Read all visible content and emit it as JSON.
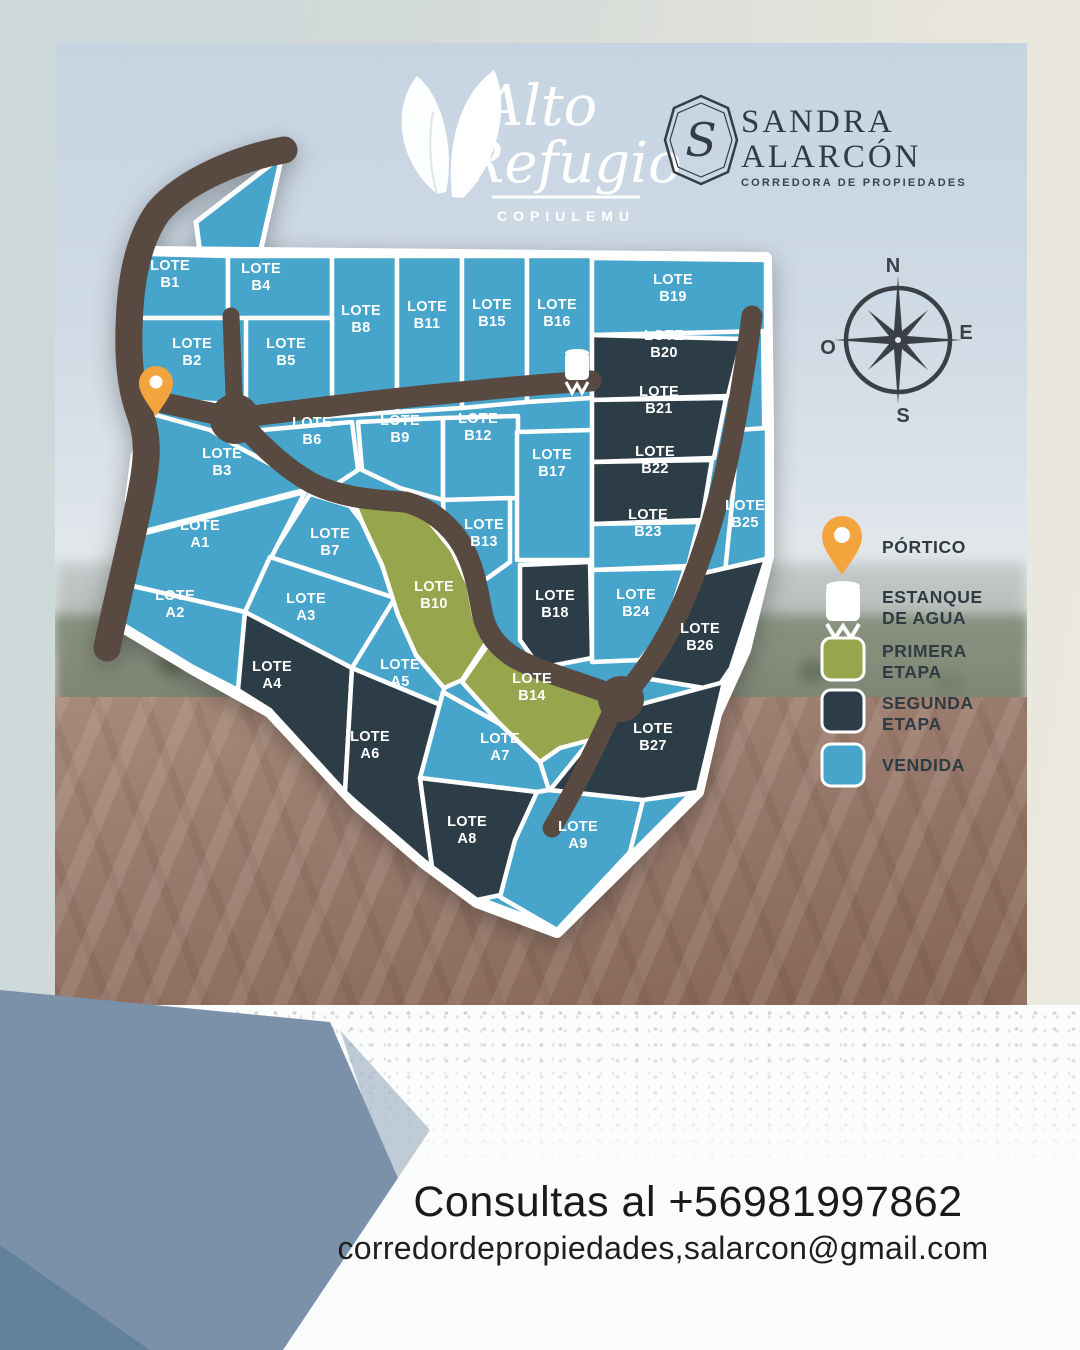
{
  "header": {
    "brand": {
      "line1": "Alto",
      "line2": "Refugio",
      "sub": "COPIULEMU"
    },
    "realtor": {
      "monogram": "S",
      "name1": "SANDRA",
      "name2": "ALARCÓN",
      "tagline": "CORREDORA DE PROPIEDADES"
    }
  },
  "compass": {
    "n": "N",
    "e": "E",
    "s": "S",
    "o": "O"
  },
  "legend": {
    "portico": "PÓRTICO",
    "estanque1": "ESTANQUE",
    "estanque2": "DE AGUA",
    "primera1": "PRIMERA",
    "primera2": "ETAPA",
    "segunda1": "SEGUNDA",
    "segunda2": "ETAPA",
    "vendida": "VENDIDA"
  },
  "colors": {
    "vendida": "#47a4cb",
    "primera": "#97a64c",
    "segunda": "#2c3d47",
    "road": "#584a40",
    "portico_pin": "#f4a43c",
    "line": "#ffffff"
  },
  "footer": {
    "line1": "Consultas al +56981997862",
    "line2": "corredordepropiedades,salarcon@gmail.com"
  },
  "map": {
    "lot_prefix": "LOTE",
    "lots": [
      {
        "id": "B1",
        "status": "vendida",
        "points": "150,254 228,256 228,318 138,318 133,292 140,268",
        "lx": 170,
        "ly": 277
      },
      {
        "id": "B4",
        "status": "vendida",
        "points": "228,256 332,256 332,318 228,318",
        "lx": 261,
        "ly": 280
      },
      {
        "id": "B8",
        "status": "vendida",
        "points": "332,256 397,256 397,412 332,416",
        "lx": 361,
        "ly": 322
      },
      {
        "id": "B11",
        "status": "vendida",
        "points": "397,256 462,256 462,408 397,412",
        "lx": 427,
        "ly": 318
      },
      {
        "id": "B15",
        "status": "vendida",
        "points": "462,256 527,256 527,402 462,408",
        "lx": 492,
        "ly": 316
      },
      {
        "id": "B16",
        "status": "vendida",
        "points": "527,256 592,256 592,398 527,402",
        "lx": 557,
        "ly": 316
      },
      {
        "id": "B19",
        "status": "vendida",
        "points": "592,258 766,260 766,331 592,335",
        "lx": 673,
        "ly": 291
      },
      {
        "id": "B2",
        "status": "vendida",
        "points": "138,318 228,318 228,404 196,402 158,398 131,364",
        "lx": 192,
        "ly": 355
      },
      {
        "id": "B5",
        "status": "vendida",
        "points": "246,318 332,318 332,412 246,408",
        "lx": 286,
        "ly": 355
      },
      {
        "id": "B6",
        "status": "vendida",
        "points": "262,430 352,422 358,470 332,487 300,477 268,452",
        "lx": 312,
        "ly": 434
      },
      {
        "id": "B9",
        "status": "vendida",
        "points": "358,422 443,418 443,500 400,488 362,470",
        "lx": 400,
        "ly": 432
      },
      {
        "id": "B12",
        "status": "vendida",
        "points": "443,418 518,416 518,498 443,500",
        "lx": 478,
        "ly": 430
      },
      {
        "id": "B13",
        "status": "vendida",
        "points": "443,500 510,498 510,562 478,585 458,552 444,520",
        "lx": 484,
        "ly": 536
      },
      {
        "id": "B17",
        "status": "vendida",
        "points": "517,432 592,430 592,560 517,560",
        "lx": 552,
        "ly": 466
      },
      {
        "id": "B3",
        "status": "vendida",
        "points": "152,414 210,430 240,448 270,464 300,480 312,488 137,533 127,500 133,455",
        "lx": 222,
        "ly": 465
      },
      {
        "id": "B7",
        "status": "vendida",
        "points": "310,494 350,506 362,522 382,565 395,598 270,557",
        "lx": 330,
        "ly": 545
      },
      {
        "id": "A1",
        "status": "vendida",
        "points": "134,536 305,492 272,556 245,612 124,584",
        "lx": 200,
        "ly": 537
      },
      {
        "id": "A2",
        "status": "vendida",
        "points": "124,584 245,612 238,690 193,667 109,616",
        "lx": 175,
        "ly": 607
      },
      {
        "id": "A3",
        "status": "vendida",
        "points": "270,557 395,598 352,668 245,612",
        "lx": 306,
        "ly": 610
      },
      {
        "id": "A4",
        "status": "segunda",
        "points": "245,612 352,668 345,792 270,710 238,690",
        "lx": 272,
        "ly": 678
      },
      {
        "id": "A5",
        "status": "vendida",
        "points": "395,598 416,655 444,688 443,706 352,668",
        "lx": 400,
        "ly": 676
      },
      {
        "id": "A6",
        "status": "segunda",
        "points": "352,668 443,706 420,778 432,867 423,860 357,803 345,792",
        "lx": 370,
        "ly": 748
      },
      {
        "id": "A7",
        "status": "vendida",
        "points": "443,692 500,724 540,762 549,790 537,792 420,778",
        "lx": 500,
        "ly": 750
      },
      {
        "id": "A8",
        "status": "segunda",
        "points": "420,778 537,792 510,893 477,900 432,867",
        "lx": 467,
        "ly": 833
      },
      {
        "id": "A9",
        "status": "vendida",
        "points": "549,790 643,800 630,852 557,930 500,897 515,840 537,792",
        "lx": 578,
        "ly": 838
      },
      {
        "id": "B10",
        "status": "primera",
        "points": "350,492 398,505 428,520 452,550 468,584 474,616 488,640 462,680 444,688 416,655 398,615 382,565 362,522",
        "lx": 434,
        "ly": 598
      },
      {
        "id": "B14",
        "status": "primera",
        "points": "462,682 490,642 516,660 556,676 598,694 610,704 598,738 560,748 540,762 500,724",
        "lx": 532,
        "ly": 690
      },
      {
        "id": "B18",
        "status": "segunda",
        "points": "520,565 590,562 592,658 540,668 520,640",
        "lx": 555,
        "ly": 607
      },
      {
        "id": "B20",
        "status": "segunda",
        "points": "592,335 742,339 728,396 592,400",
        "lx": 664,
        "ly": 347
      },
      {
        "id": "B21",
        "status": "segunda",
        "points": "592,400 726,398 714,458 592,462",
        "lx": 659,
        "ly": 403
      },
      {
        "id": "B22",
        "status": "segunda",
        "points": "592,462 712,460 702,520 592,524",
        "lx": 655,
        "ly": 463
      },
      {
        "id": "B23",
        "status": "vendida",
        "points": "592,524 699,522 688,566 592,570",
        "lx": 648,
        "ly": 526
      },
      {
        "id": "B25",
        "status": "vendida",
        "points": "737,430 767,428 767,556 746,620 725,572 733,494",
        "lx": 745,
        "ly": 517
      },
      {
        "id": "B24",
        "status": "vendida",
        "points": "592,570 685,568 666,628 640,660 592,662",
        "lx": 636,
        "ly": 606
      },
      {
        "id": "B26",
        "status": "segunda",
        "points": "668,622 695,575 766,559 731,668 716,690 644,678 648,658",
        "lx": 700,
        "ly": 640
      },
      {
        "id": "B27",
        "status": "segunda",
        "points": "550,790 584,748 612,712 724,682 698,792 643,800",
        "lx": 653,
        "ly": 740
      }
    ]
  }
}
